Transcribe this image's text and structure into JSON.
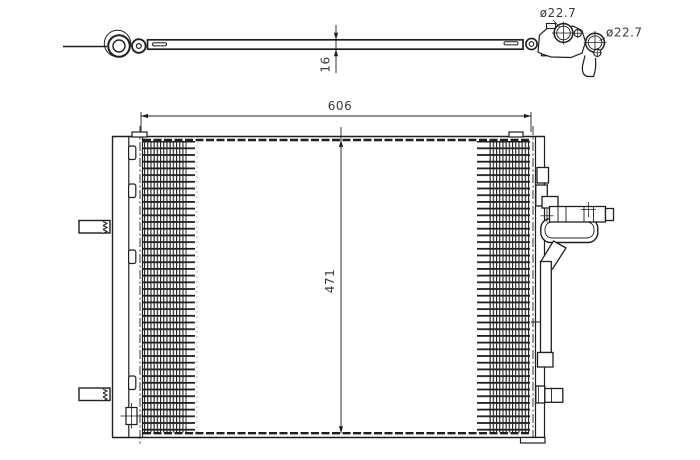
{
  "page": {
    "background": "#ffffff"
  },
  "drawing": {
    "type": "technical-drawing",
    "subject": "air-conditioning condenser part diagram",
    "line_color": "#1f1f1f",
    "text_color": "#3a3a3a",
    "views": {
      "top_view": "thin horizontal profile with pipe ring fittings at both ends",
      "front_view": "rectangular condenser core with finned sections, side brackets and receiver-drier pipe"
    },
    "labels": {
      "core_width": "606",
      "core_height": "471",
      "depth": "16",
      "port_top": "ø22.7",
      "port_side": "ø22.7"
    }
  }
}
